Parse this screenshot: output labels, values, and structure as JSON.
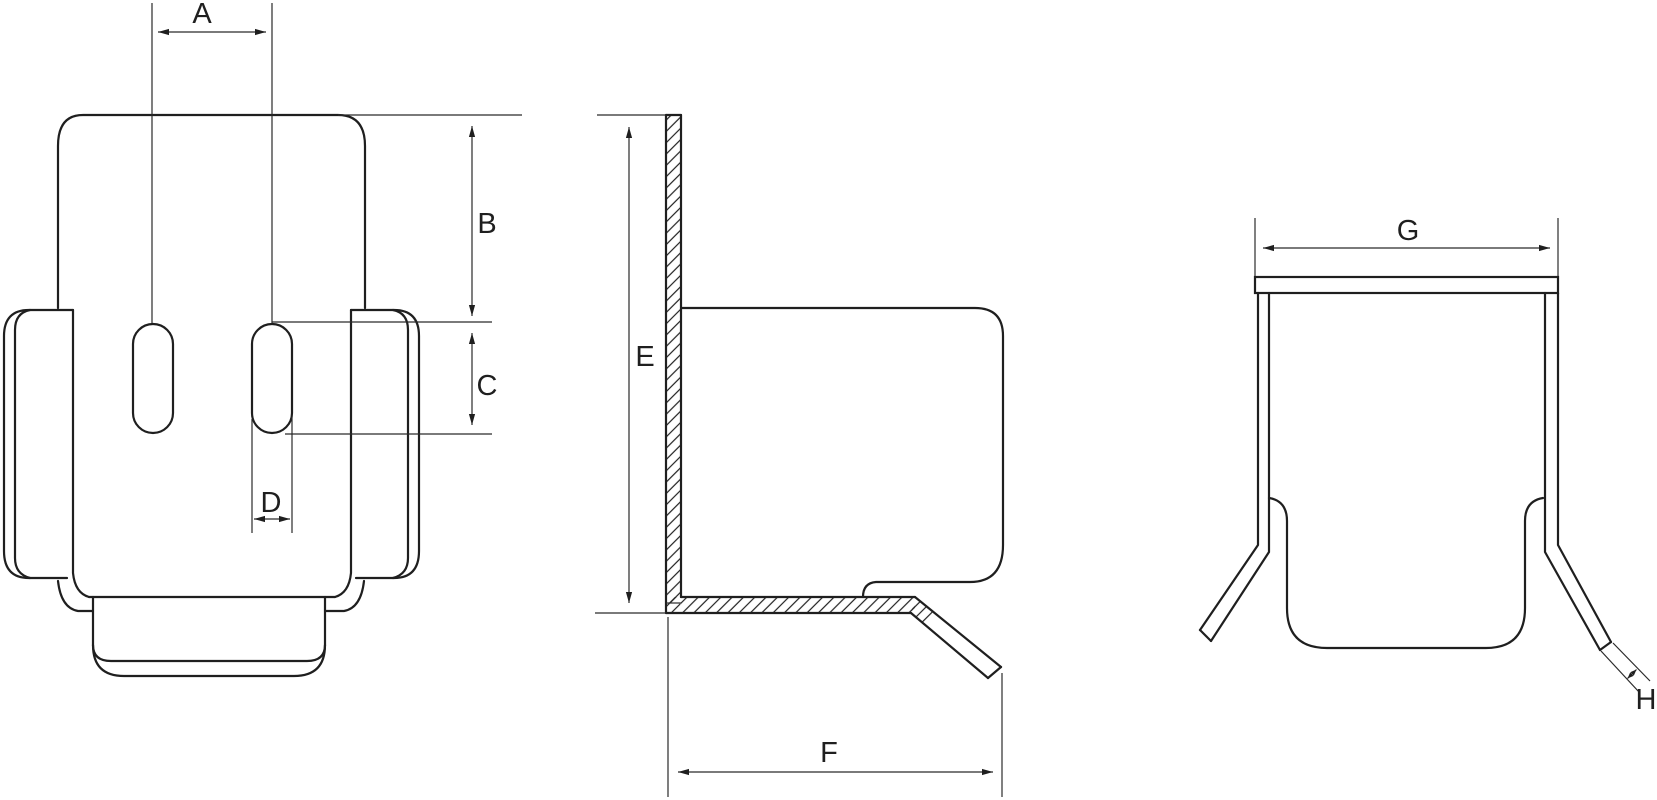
{
  "colors": {
    "background": "#ffffff",
    "line": "#1f1f1f"
  },
  "dimensions": {
    "a": "A",
    "b": "B",
    "c": "C",
    "d": "D",
    "e": "E",
    "f": "F",
    "g": "G",
    "h": "H"
  }
}
